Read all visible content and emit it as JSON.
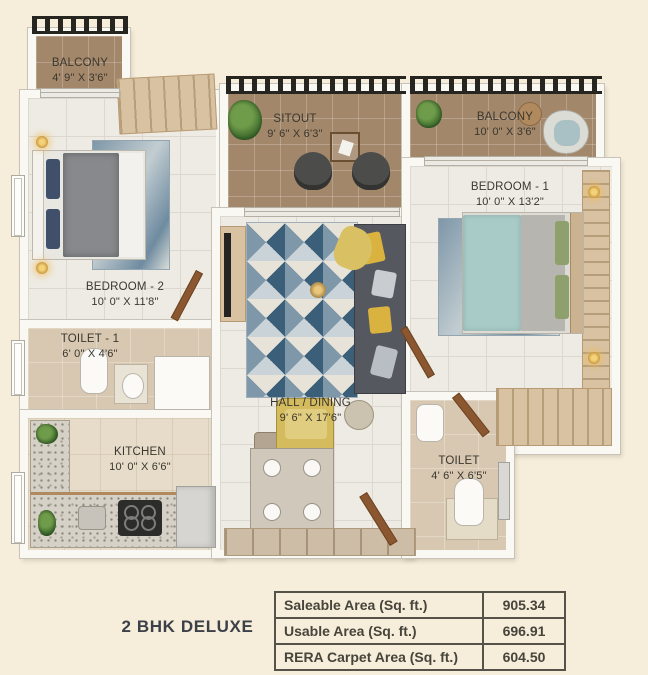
{
  "plan_title": "2 BHK DELUXE",
  "rooms": [
    {
      "name": "BALCONY",
      "dims": "4' 9\" X 3'6\""
    },
    {
      "name": "SITOUT",
      "dims": "9' 6\" X 6'3\""
    },
    {
      "name": "BALCONY",
      "dims": "10' 0\" X 3'6\""
    },
    {
      "name": "BEDROOM - 1",
      "dims": "10' 0\" X 13'2\""
    },
    {
      "name": "BEDROOM - 2",
      "dims": "10' 0\" X 11'8\""
    },
    {
      "name": "TOILET - 1",
      "dims": "6' 0\" X 4'6\""
    },
    {
      "name": "KITCHEN",
      "dims": "10' 0\" X 6'6\""
    },
    {
      "name": "HALL / DINING",
      "dims": "9' 6\" X 17'6\""
    },
    {
      "name": "TOILET",
      "dims": "4' 6\" X 6'5\""
    }
  ],
  "area_table": {
    "rows": [
      {
        "label": "Saleable Area (Sq. ft.)",
        "value": "905.34"
      },
      {
        "label": "Usable Area (Sq. ft.)",
        "value": "696.91"
      },
      {
        "label": "RERA Carpet Area (Sq. ft.)",
        "value": "604.50"
      }
    ]
  },
  "colors": {
    "background": "#f6edda",
    "wall": "#f9f8f3",
    "room_floor": "#edebe4",
    "balcony_floor": "#a3876a",
    "wet_area_floor": "#d8c8b2",
    "pergola": "#26251f",
    "rug_blue": "#3b5f78",
    "sofa_grey": "#55585e",
    "accent_yellow": "#d9c063",
    "label_text": "#3b372f",
    "table_border": "#55524a"
  }
}
